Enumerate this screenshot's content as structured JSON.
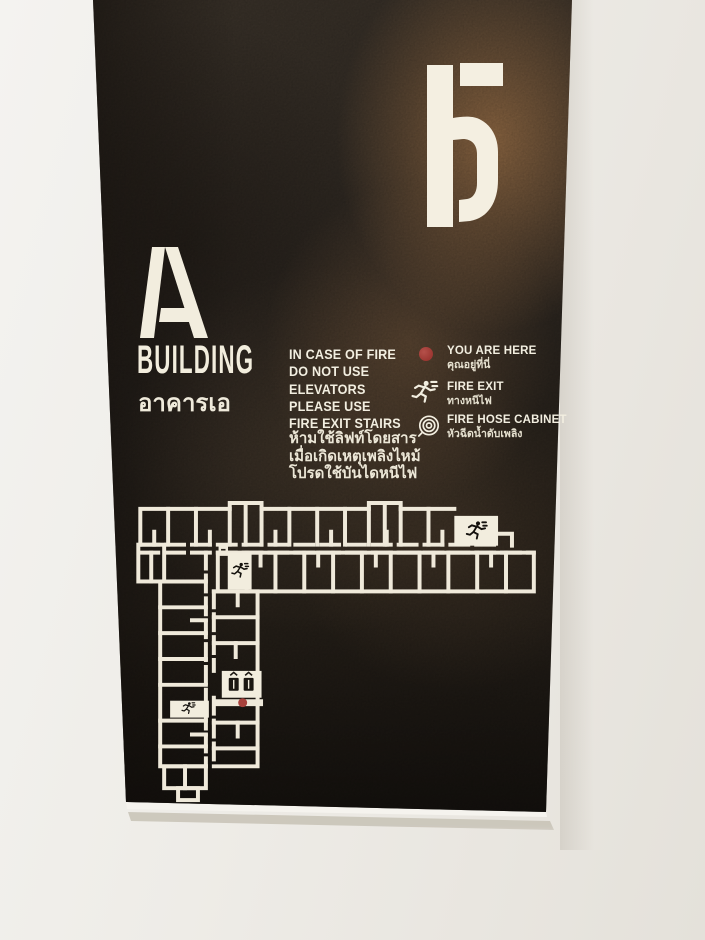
{
  "sign": {
    "floor_number": "5",
    "building_letter": "A",
    "building_word": "BUILDING",
    "building_word_th": "อาคารเอ"
  },
  "notice": {
    "en_lines": [
      "IN CASE OF FIRE",
      "DO NOT USE",
      "ELEVATORS",
      "PLEASE USE",
      "FIRE EXIT STAIRS"
    ],
    "th_lines": [
      "ห้ามใช้ลิฟท์โดยสาร",
      "เมื่อเกิดเหตุเพลิงไหม้",
      "โปรดใช้บันไดหนีไฟ"
    ]
  },
  "legend": {
    "items": [
      {
        "icon": "you-are-here-dot",
        "label_en": "YOU ARE HERE",
        "label_th": "คุณอยู่ที่นี่"
      },
      {
        "icon": "running-man",
        "label_en": "FIRE EXIT",
        "label_th": "ทางหนีไฟ"
      },
      {
        "icon": "hose-coil",
        "label_en": "FIRE HOSE CABINET",
        "label_th": "หัวฉีดน้ำดับเพลิง"
      }
    ]
  },
  "floorplan": {
    "fire_exit_count": 3,
    "elevator_count": 2,
    "has_you_are_here_marker": true
  },
  "colors": {
    "plate_dark": "#2a241e",
    "rust": "#9e7248",
    "ink_ivory": "#f1ecdd",
    "marker_red": "#a8423c",
    "wall": "#edeae4"
  }
}
